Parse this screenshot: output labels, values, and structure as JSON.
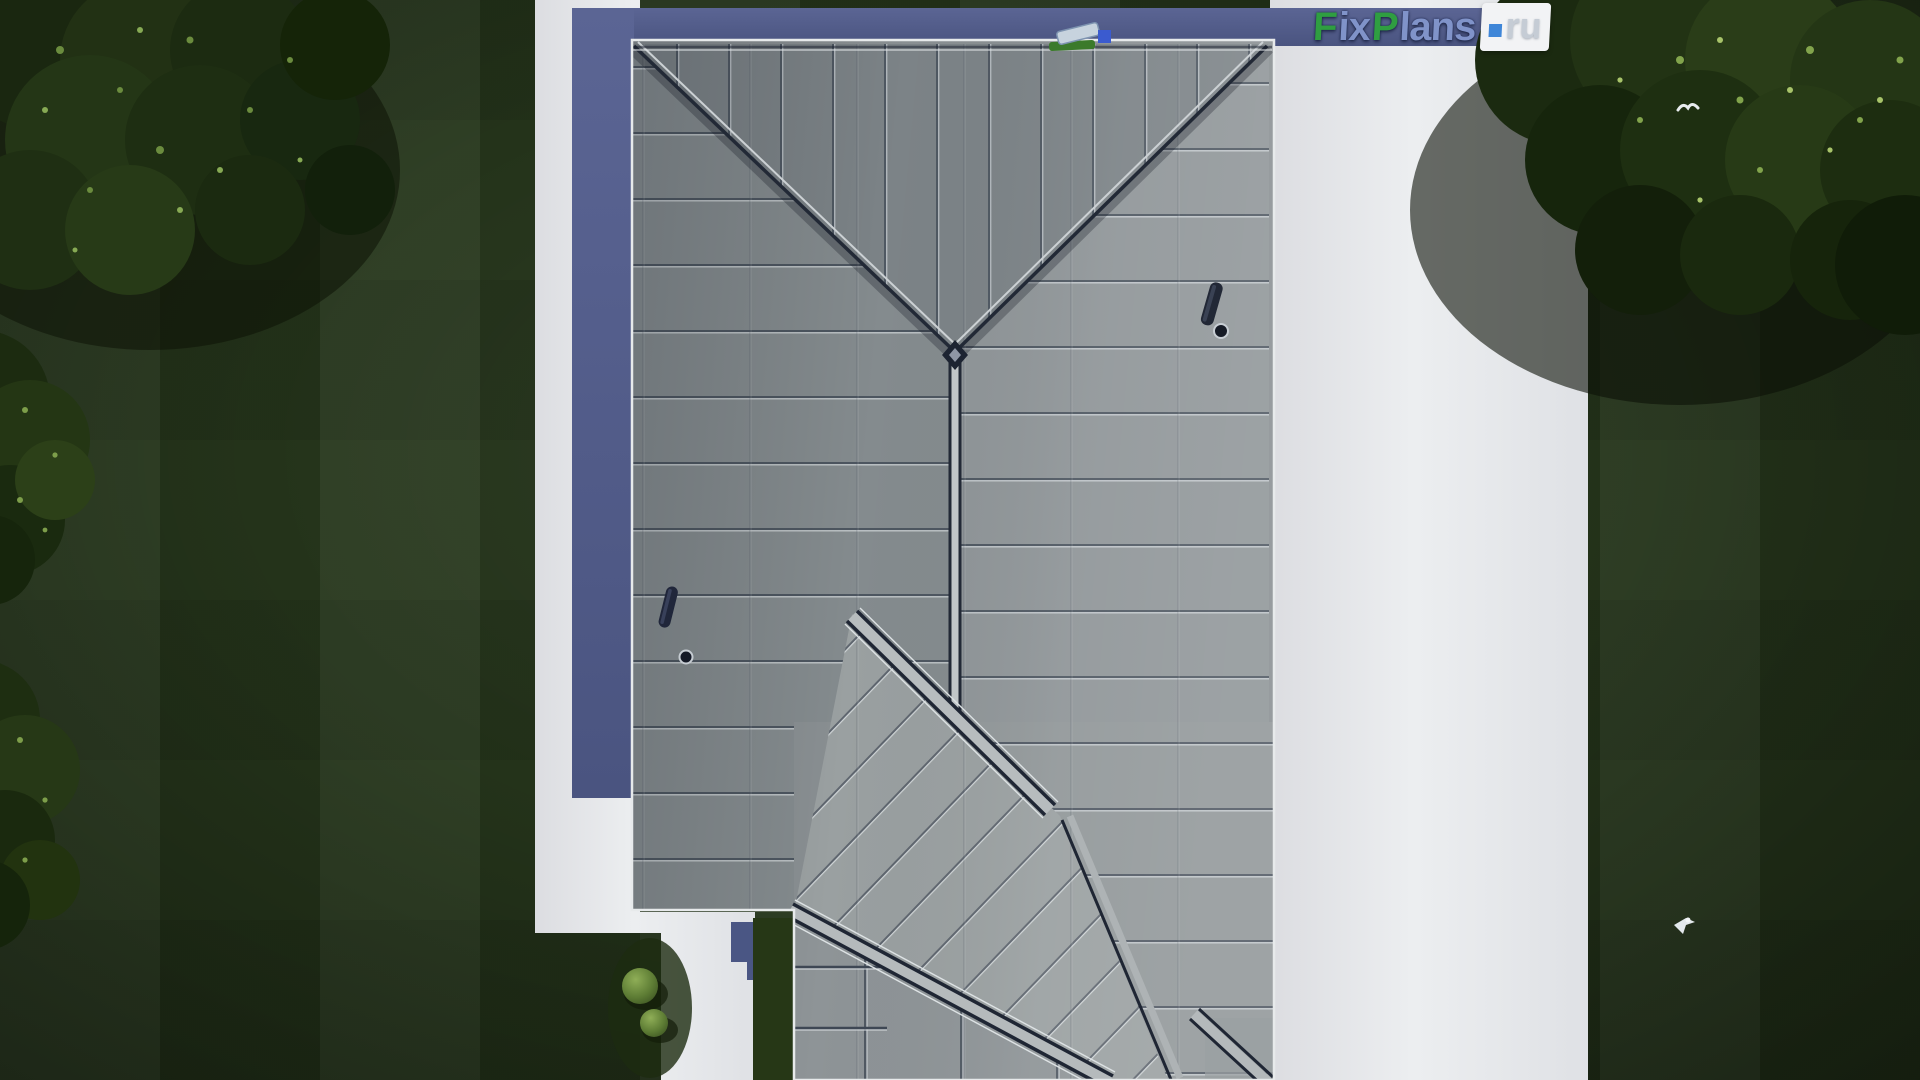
{
  "watermark": {
    "segments": [
      {
        "text": "F",
        "color": "#2f9e41"
      },
      {
        "text": "ix",
        "color": "#8093c9"
      },
      {
        "text": "P",
        "color": "#2f9e41"
      },
      {
        "text": "lans",
        "color": "#8093c9"
      }
    ],
    "tld_dot": ".",
    "tld": "ru",
    "full_text": "FixPlans.ru"
  },
  "colors": {
    "logo_green": "#2f9e41",
    "logo_blue": "#8093c9",
    "logo_ru_text": "#c5ccd5",
    "logo_dot_blue": "#3f86d8",
    "roof_panel_gray": "#8b9295",
    "roof_ridge_navy": "#1f2634",
    "roof_band_light": "#b5babc",
    "paving_white": "#e8e9eb",
    "shadow_band_blue": "#57618f",
    "lawn_green": "#26361b",
    "foliage_dark_green": "#1d2a12",
    "bush_light_green": "#7fa04c"
  }
}
